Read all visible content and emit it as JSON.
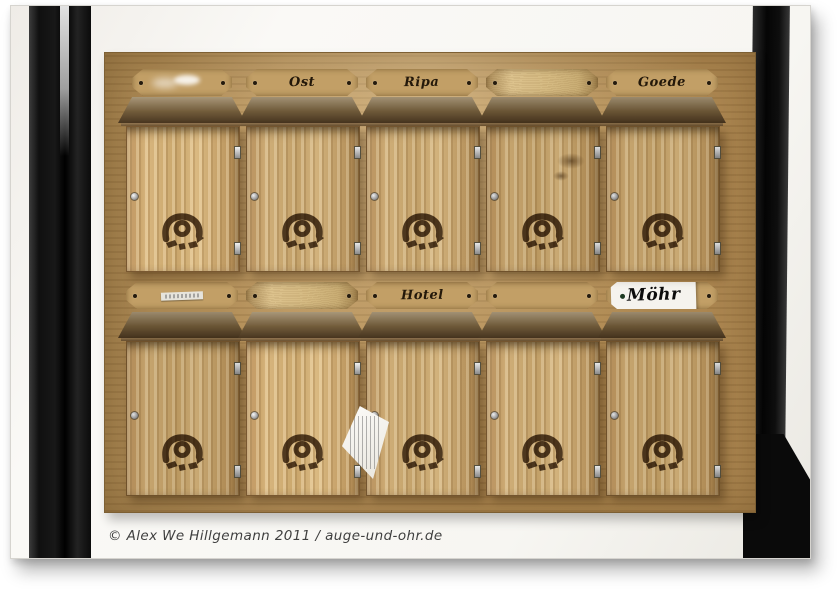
{
  "image": {
    "description": "Ten rustic wooden letter boxes with burned-in post horn emblems, mounted on a wooden board set between black timber beams of a half-timbered wall",
    "copyright": "© Alex We Hillgemann 2011 / auge-und-ohr.de"
  },
  "panel": {
    "name_plates_row1": [
      {
        "label": ""
      },
      {
        "label": "Ost"
      },
      {
        "label": "Ripa"
      },
      {
        "label": ""
      },
      {
        "label": "Goede"
      }
    ],
    "name_plates_row2": [
      {
        "label": ""
      },
      {
        "label": ""
      },
      {
        "label": "Hotel"
      },
      {
        "label": ""
      },
      {
        "label": "Möhr"
      }
    ]
  },
  "icons": {
    "emblem": "posthorn-icon",
    "hardware": [
      "hinge-icon",
      "lock-screw-icon"
    ]
  },
  "colors": {
    "wall": "#f6f5f1",
    "beam": "#141414",
    "panel_wood": "#ac8650",
    "box_wood": "#c3a06a",
    "lid_wood": "#5e4930",
    "plate_wood": "#c29f66",
    "emblem": "#3e2b14",
    "paper": "#f5f3ee",
    "text_dark": "#23180a",
    "copyright_text": "#3f3f3f"
  }
}
